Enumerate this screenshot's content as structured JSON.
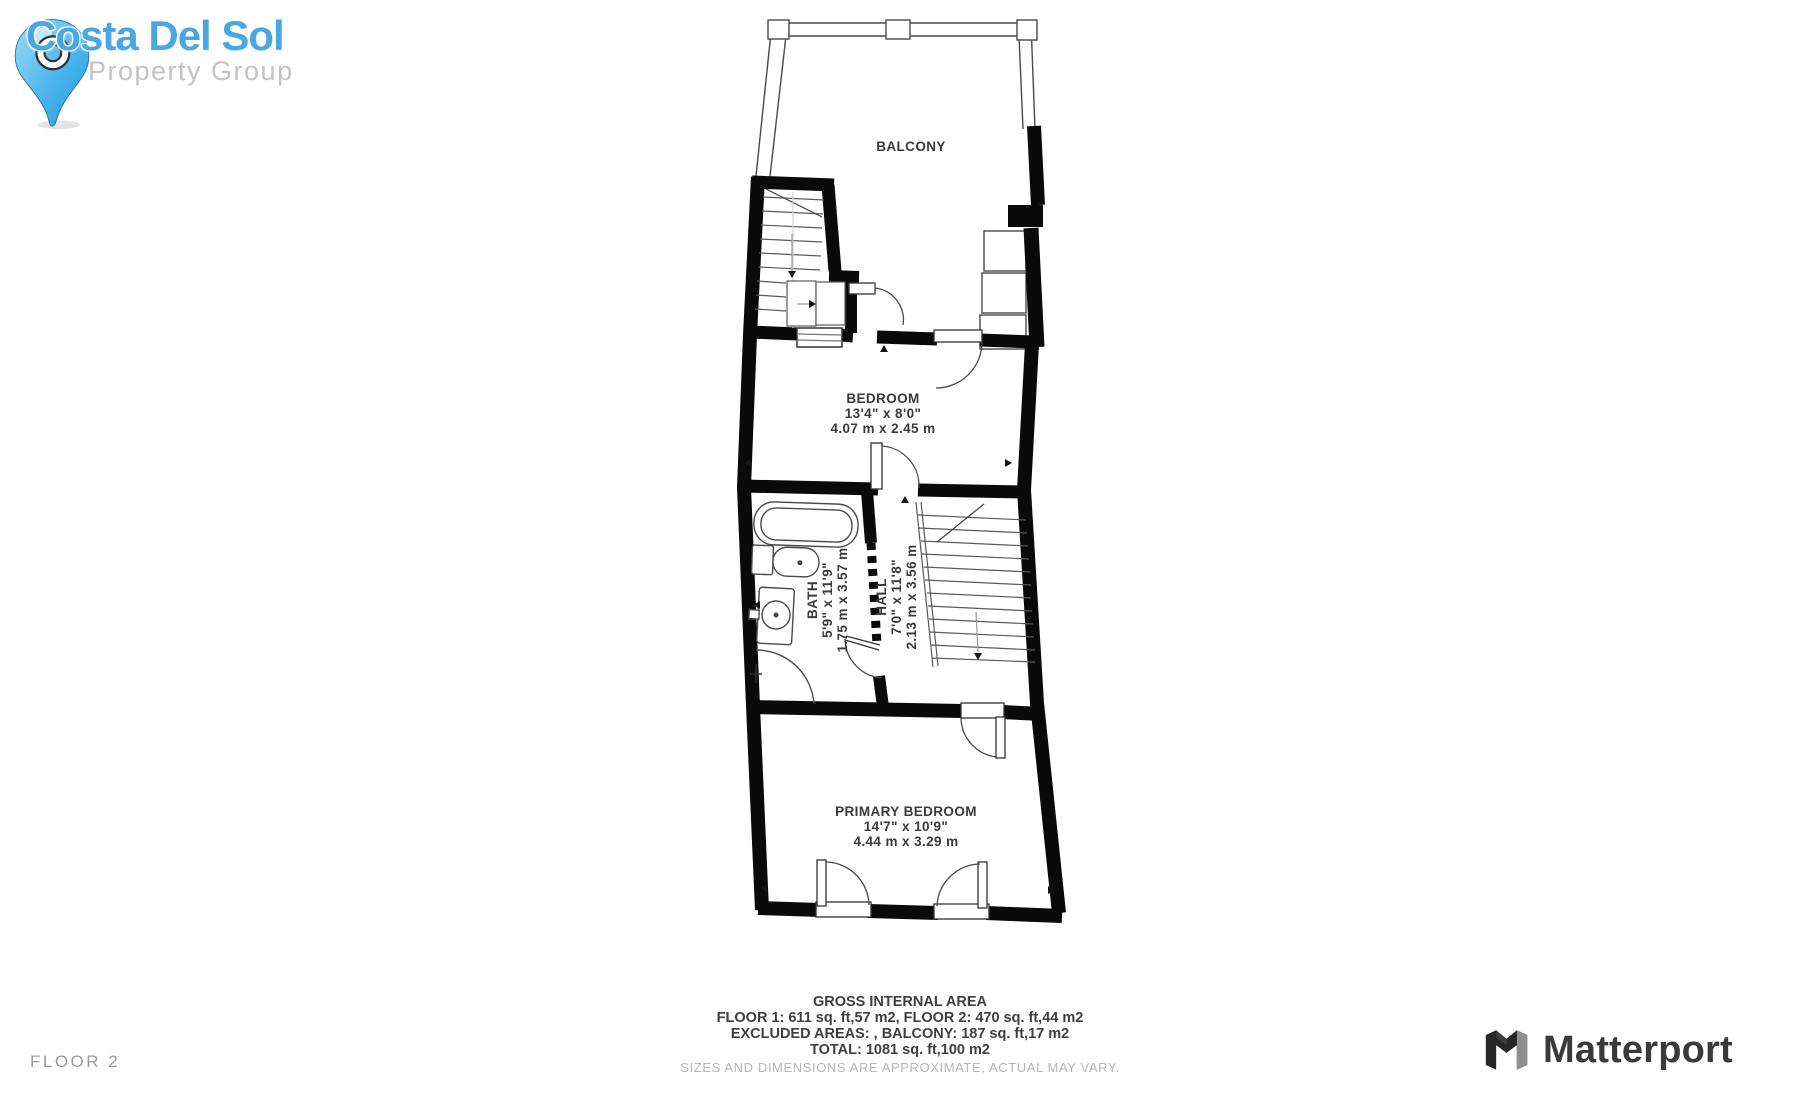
{
  "branding": {
    "title": "Costa Del Sol",
    "subtitle": "Property Group",
    "colors": {
      "title": "#49a7e3",
      "subtitle": "#c3c3c3",
      "pin_light": "#9adcf9",
      "pin_dark": "#1e9ae0"
    }
  },
  "floor_label": "FLOOR 2",
  "matterport_label": "Matterport",
  "plan": {
    "wall_color": "#0a0a0a",
    "labels": {
      "balcony": {
        "name": "BALCONY"
      },
      "bedroom": {
        "name": "BEDROOM",
        "imperial": "13'4\" x 8'0\"",
        "metric": "4.07 m x 2.45 m"
      },
      "bath": {
        "name": "BATH",
        "imperial": "5'9\" x 11'9\"",
        "metric": "1.75 m x 3.57 m"
      },
      "hall": {
        "name": "HALL",
        "imperial": "7'0\" x 11'8\"",
        "metric": "2.13 m x 3.56 m"
      },
      "primary_bedroom": {
        "name": "PRIMARY BEDROOM",
        "imperial": "14'7\" x 10'9\"",
        "metric": "4.44 m x 3.29 m"
      }
    }
  },
  "footer": {
    "title": "GROSS INTERNAL AREA",
    "floors": "FLOOR 1: 611 sq. ft,57 m2, FLOOR 2: 470 sq. ft,44 m2",
    "excluded": "EXCLUDED AREAS: , BALCONY: 187 sq. ft,17 m2",
    "total": "TOTAL: 1081 sq. ft,100 m2",
    "disclaimer": "SIZES AND DIMENSIONS ARE APPROXIMATE, ACTUAL MAY VARY."
  }
}
